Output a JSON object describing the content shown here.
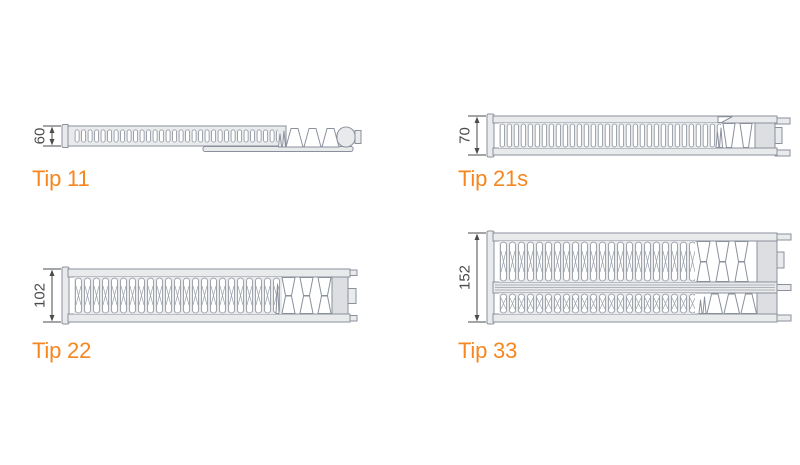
{
  "figures": [
    {
      "id": "tip11",
      "label": "Tip 11",
      "height": "60"
    },
    {
      "id": "tip21s",
      "label": "Tip 21s",
      "height": "70"
    },
    {
      "id": "tip22",
      "label": "Tip 22",
      "height": "102"
    },
    {
      "id": "tip33",
      "label": "Tip 33",
      "height": "152"
    }
  ],
  "colors": {
    "accent_orange": "#F6861F",
    "outline_gray": "#8A919C",
    "metal_fill": "#E9EAEC",
    "dimension_gray": "#4A4B4D"
  }
}
